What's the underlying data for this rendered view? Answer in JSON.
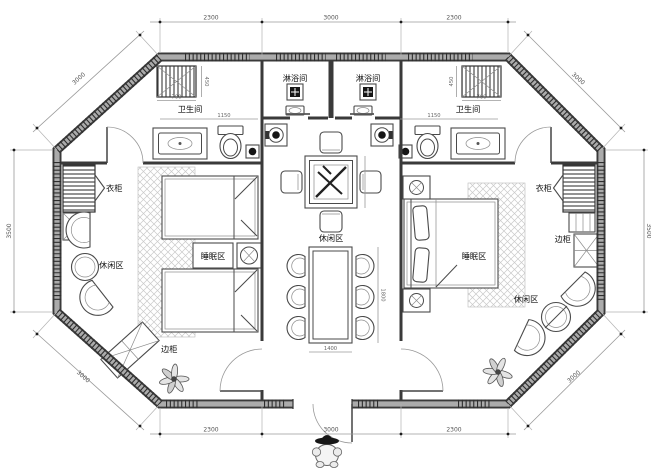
{
  "drawing": {
    "labels": {
      "shower_left": "淋浴间",
      "shower_right": "淋浴间",
      "bathroom_left": "卫生间",
      "bathroom_right": "卫生间",
      "wardrobe_left": "衣柜",
      "wardrobe_right": "衣柜",
      "sleep_left": "睡眠区",
      "sleep_right": "睡眠区",
      "lounge_left": "休闲区",
      "lounge_center": "休闲区",
      "lounge_right": "休闲区",
      "side_cabinet_left": "边柜",
      "side_cabinet_right": "边柜"
    },
    "dimensions": {
      "top_left": "2300",
      "top_center": "3000",
      "top_right": "2300",
      "bottom_left": "2300",
      "bottom_center": "3000",
      "bottom_right": "2300",
      "side_left": "3500",
      "side_right": "3500",
      "diag_top_left": "3000",
      "diag_top_right": "3000",
      "diag_bottom_left": "3000",
      "diag_bottom_right": "3000",
      "shelf_left": "700",
      "shelf_right": "700",
      "shelf_depth_left": "450",
      "shelf_depth_right": "450",
      "bath_left_width": "1150",
      "bath_right_width": "1150",
      "dining_length": "1800",
      "dining_width": "1400"
    },
    "colors": {
      "wall_dark": "#3a3a3a",
      "wall_fill": "#ababab",
      "line": "#4a4a4a",
      "dim_line": "#9a9a9a",
      "label_text": "#111111",
      "hatch": "#c9c9c9",
      "background": "#ffffff"
    }
  }
}
